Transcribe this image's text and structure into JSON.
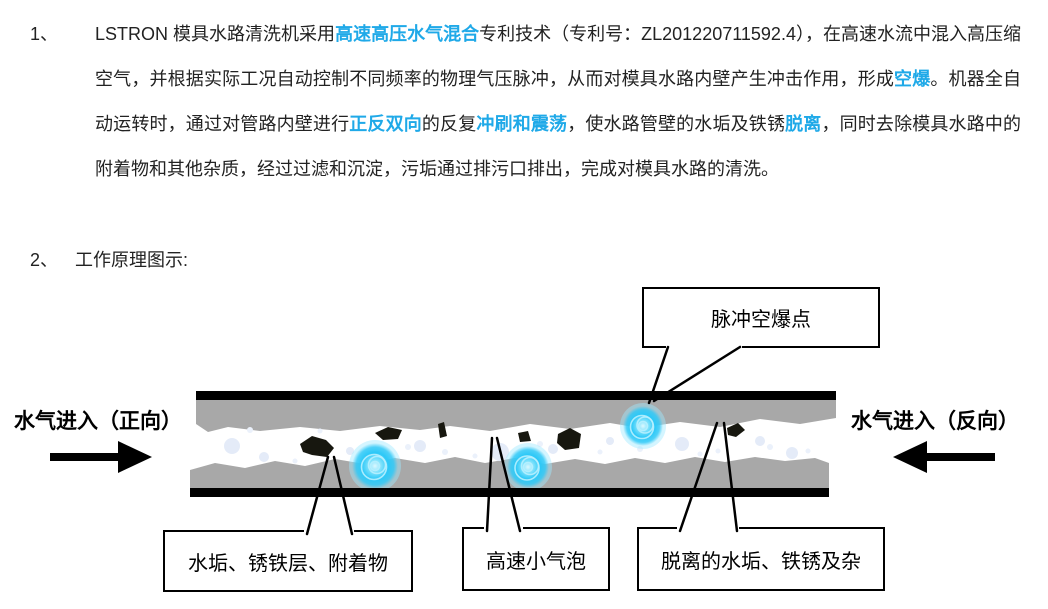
{
  "colors": {
    "highlight_blue": "#1fa9e8",
    "pipe_scale_gray": "#a8a8a8",
    "cavitation_cyan": "#2cc8f7"
  },
  "item1": {
    "number": "1、",
    "segments": [
      {
        "text": "LSTRON 模具水路清洗机采用",
        "hl": false
      },
      {
        "text": "高速高压水气混合",
        "hl": true
      },
      {
        "text": "专利技术（专利号：ZL201220711592.4），在高速水流中混入高压缩空气，并根据实际工况自动控制不同频率的物理气压脉冲，从而对模具水路内壁产生冲击作用，形成",
        "hl": false
      },
      {
        "text": "空爆",
        "hl": true
      },
      {
        "text": "。机器全自动运转时，通过对管路内壁进行",
        "hl": false
      },
      {
        "text": "正反双向",
        "hl": true
      },
      {
        "text": "的反复",
        "hl": false
      },
      {
        "text": "冲刷和震荡",
        "hl": true
      },
      {
        "text": "，使水路管壁的水垢及铁锈",
        "hl": false
      },
      {
        "text": "脱离",
        "hl": true
      },
      {
        "text": "，同时去除模具水路中的附着物和其他杂质，经过过滤和沉淀，污垢通过排污口排出，完成对模具水路的清洗。",
        "hl": false
      }
    ]
  },
  "item2": {
    "number": "2、",
    "label": "工作原理图示:"
  },
  "diagram": {
    "callout_pulse": "脉冲空爆点",
    "label_forward": "水气进入（正向）",
    "label_reverse": "水气进入（反向）",
    "callout_scale": "水垢、锈铁层、附着物",
    "callout_bubbles": "高速小气泡",
    "callout_debris": "脱离的水垢、铁锈及杂"
  }
}
